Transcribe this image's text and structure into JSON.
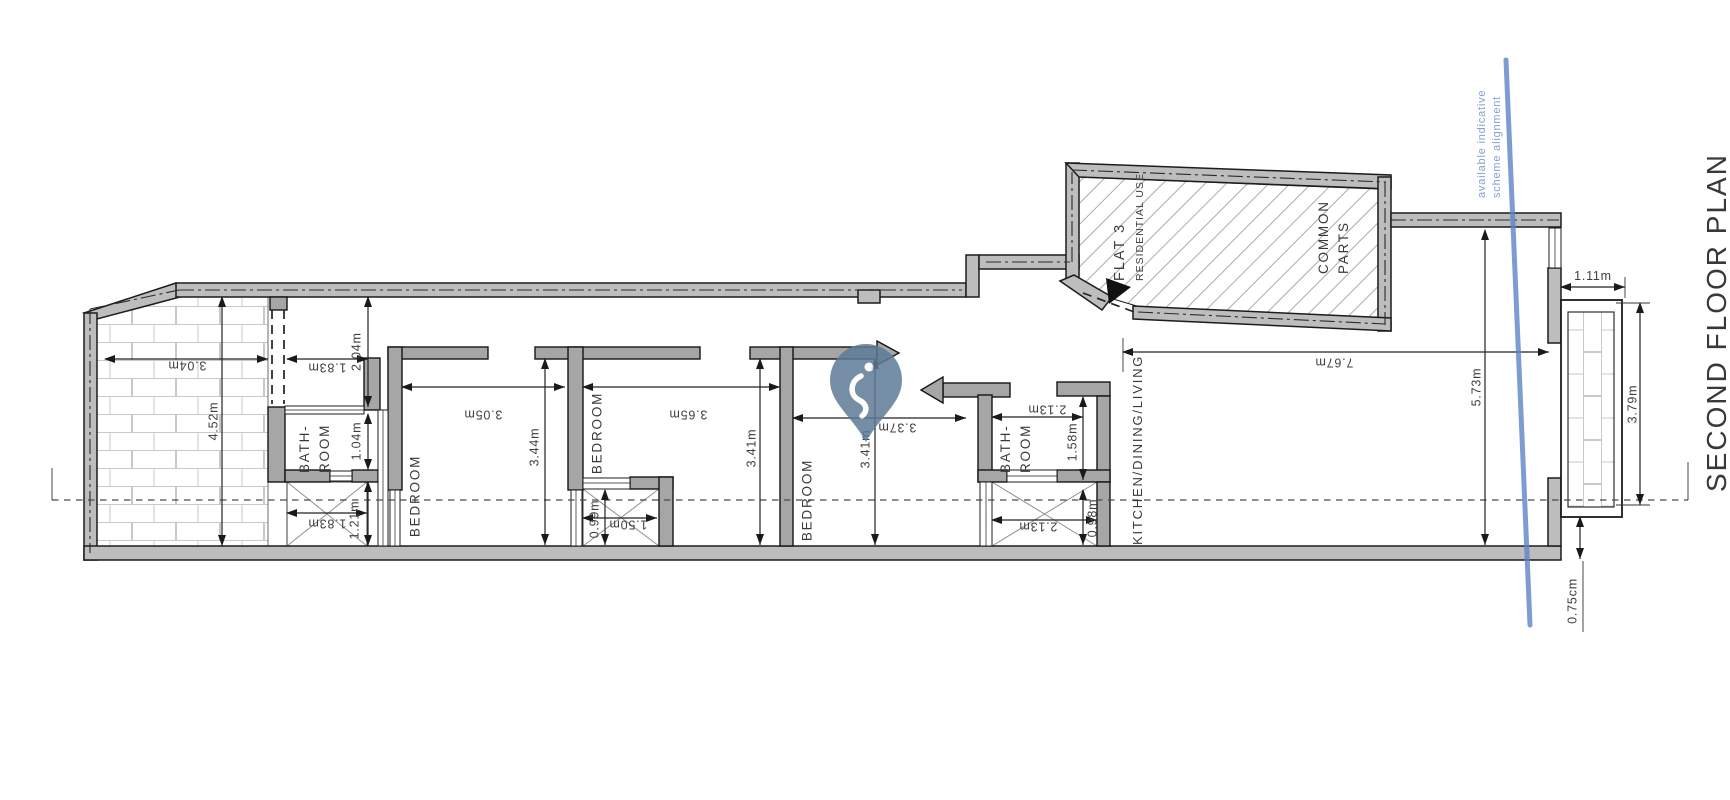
{
  "title": "SECOND FLOOR PLAN",
  "note": {
    "line1": "available indicative",
    "line2": "scheme alignment",
    "line_color": "#5d84c6"
  },
  "rooms": {
    "bathroom1": {
      "line1": "BATH-",
      "line2": "ROOM"
    },
    "bedroom1": {
      "label": "BEDROOM"
    },
    "bedroom2": {
      "label": "BEDROOM"
    },
    "bedroom3": {
      "label": "BEDROOM"
    },
    "bathroom2": {
      "line1": "BATH-",
      "line2": "ROOM"
    },
    "kitchen": {
      "label": "KITCHEN/DINING/LIVING"
    },
    "flat3": {
      "line1": "FLAT 3",
      "line2": "RESIDENTIAL USE"
    },
    "common_parts": {
      "line1": "COMMON",
      "line2": "PARTS"
    }
  },
  "dimensions": {
    "terrace_width": "3.04m",
    "terrace_depth": "4.52m",
    "hall_width": "1.83m",
    "hall_depth": "2.04m",
    "bath1_depth": "1.04m",
    "bay1_width": "1.83m",
    "bay1_depth": "1.21m",
    "bed1_width": "3.05m",
    "bed1_depth": "3.44m",
    "bed2_width": "3.65m",
    "bed2_depth": "3.41m",
    "bay2_depth": "0.99m",
    "bay2_width": "1.50m",
    "bed3_width": "3.37m",
    "bed3_depth": "3.41m",
    "bath2_width": "2.13m",
    "bath2_depth": "1.58m",
    "bay3_width": "2.13m",
    "bay3_depth": "0.98m",
    "living_width": "7.67m",
    "living_depth": "5.73m",
    "balcony_width": "1.11m",
    "balcony_depth": "3.79m",
    "balcony_offset": "0.75cm"
  }
}
